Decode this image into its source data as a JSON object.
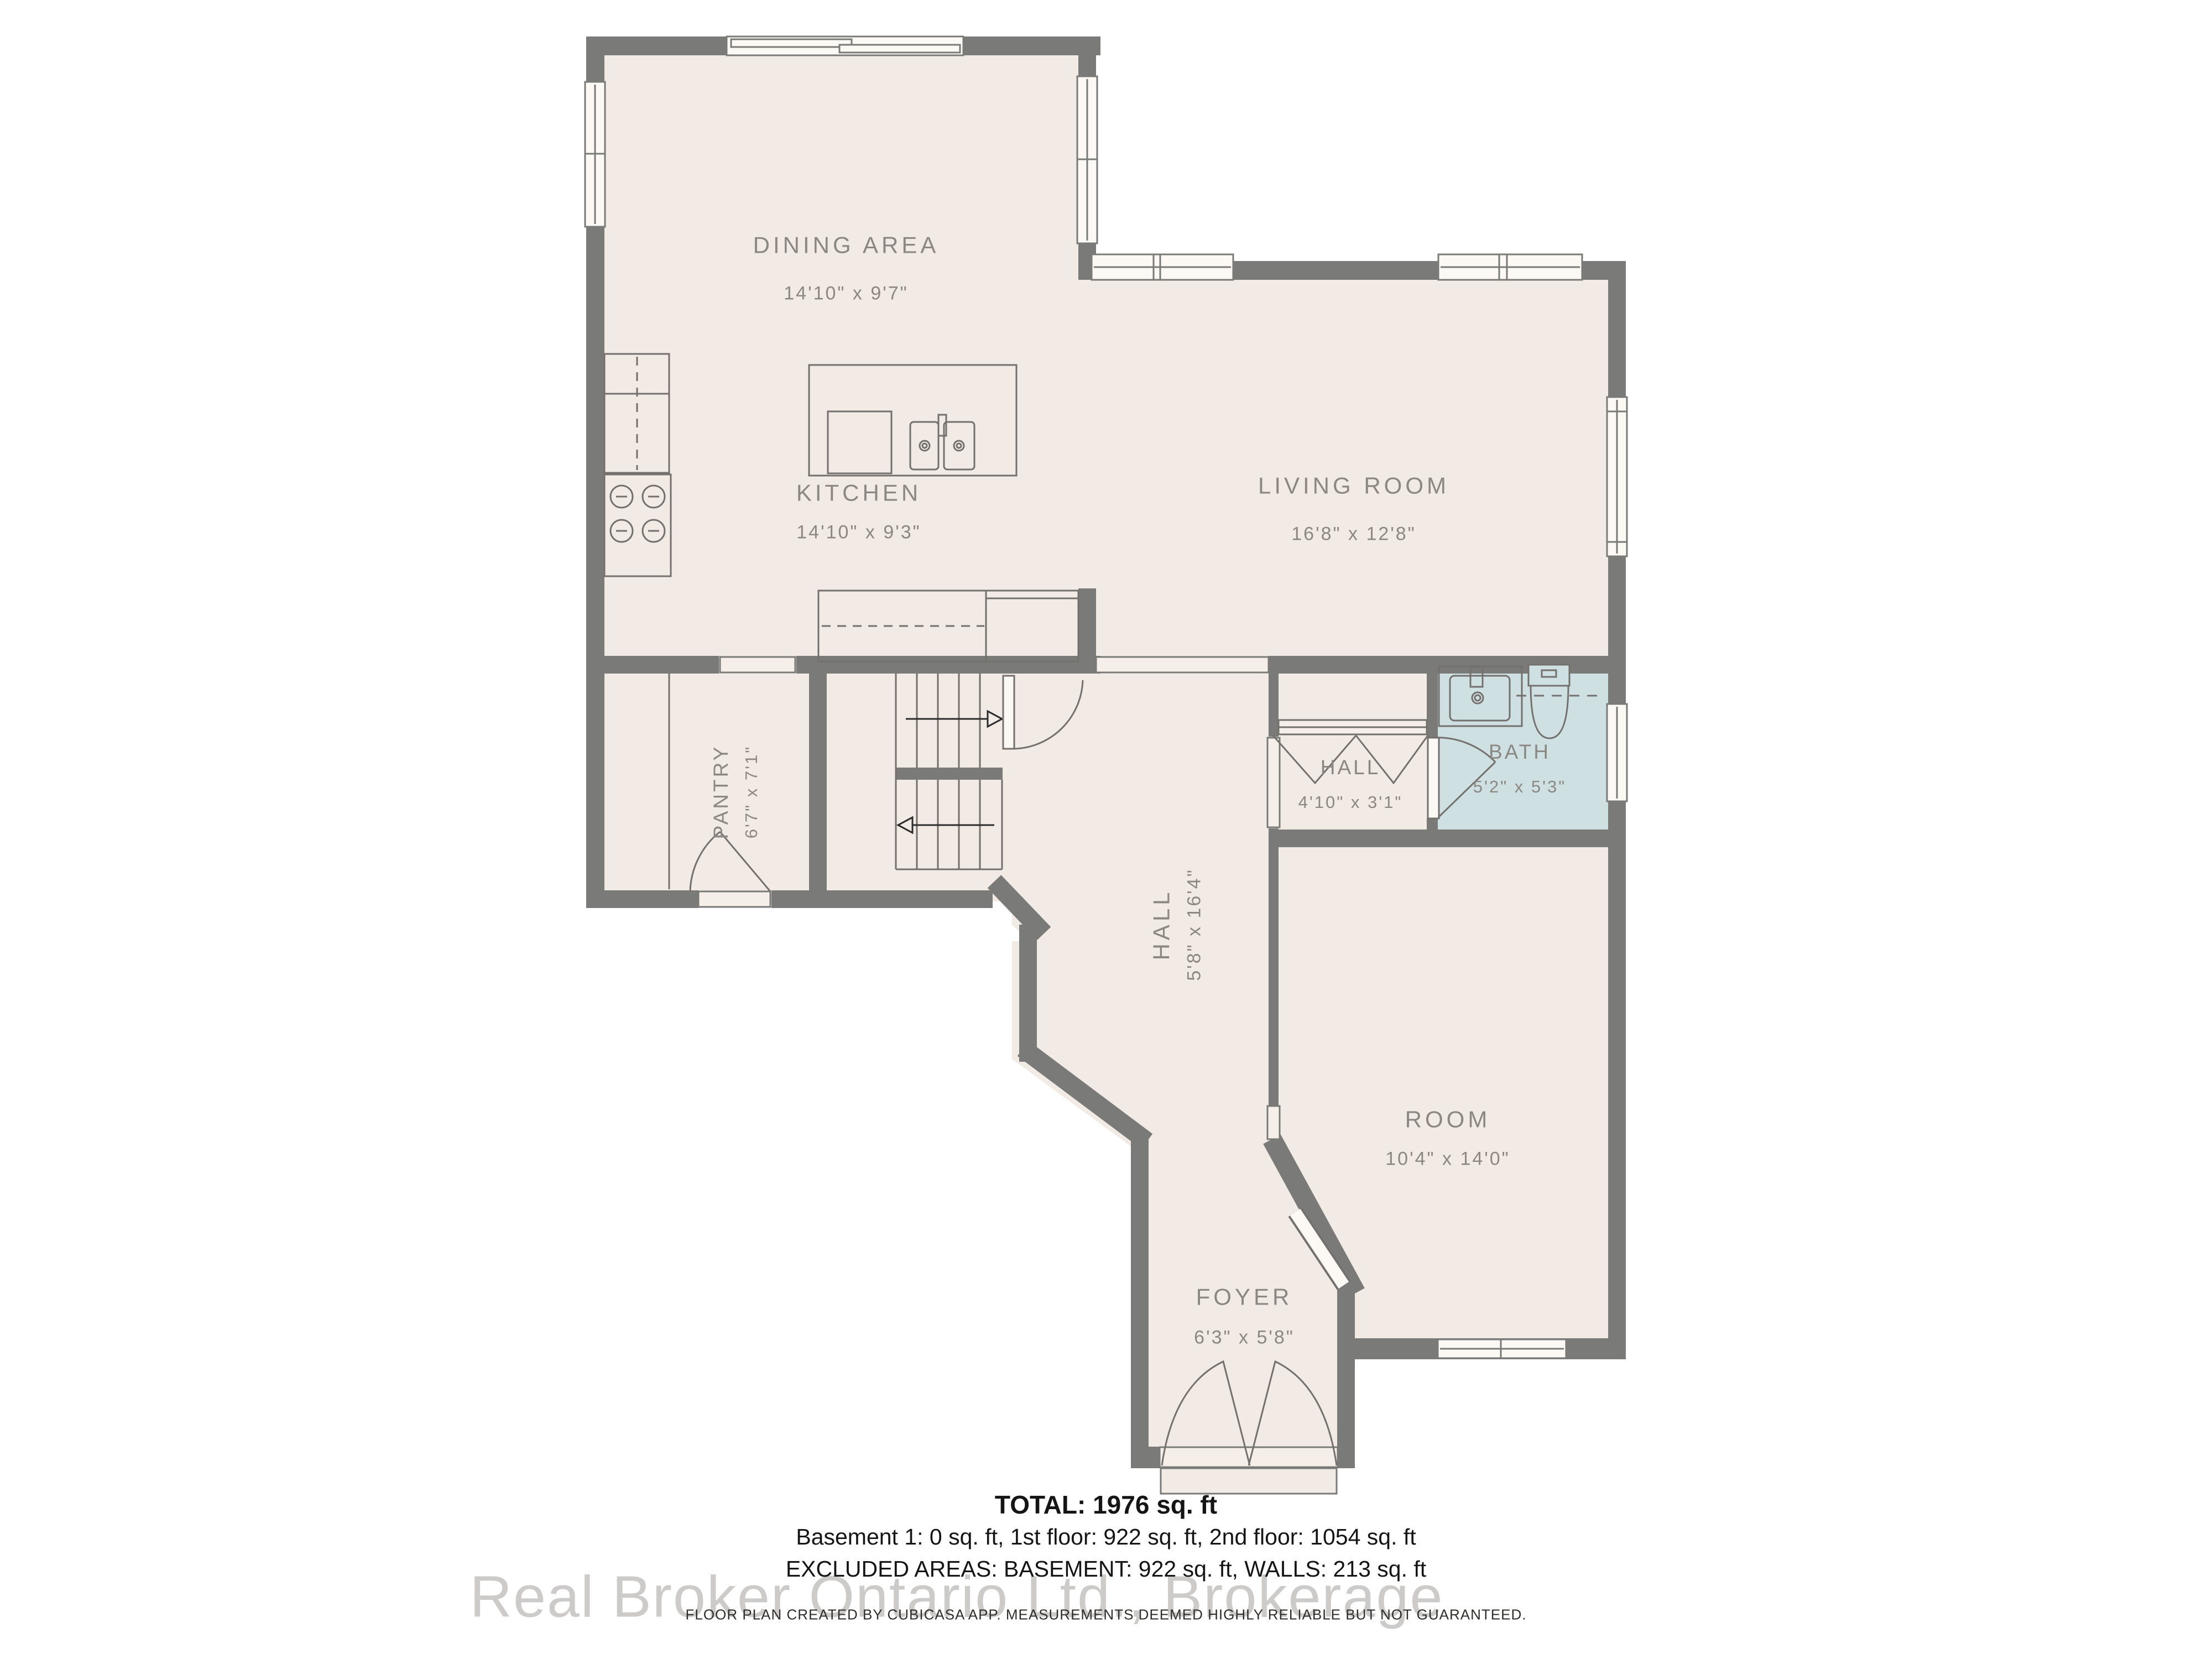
{
  "rooms": {
    "dining": {
      "name": "DINING AREA",
      "dims": "14'10\" x 9'7\""
    },
    "kitchen": {
      "name": "KITCHEN",
      "dims": "14'10\" x 9'3\""
    },
    "living": {
      "name": "LIVING ROOM",
      "dims": "16'8\" x 12'8\""
    },
    "pantry": {
      "name": "PANTRY",
      "dims": "6'7\" x 7'1\""
    },
    "hall": {
      "name": "HALL",
      "dims": "5'8\" x 16'4\""
    },
    "hall2": {
      "name": "HALL",
      "dims": "4'10\" x 3'1\""
    },
    "bath": {
      "name": "BATH",
      "dims": "5'2\" x 5'3\""
    },
    "room": {
      "name": "ROOM",
      "dims": "10'4\" x 14'0\""
    },
    "foyer": {
      "name": "FOYER",
      "dims": "6'3\" x 5'8\""
    }
  },
  "summary": {
    "total": "TOTAL: 1976 sq. ft",
    "floors": "Basement 1: 0 sq. ft, 1st floor: 922 sq. ft, 2nd floor: 1054 sq. ft",
    "excluded": "EXCLUDED AREAS: BASEMENT: 922 sq. ft, WALLS: 213 sq. ft"
  },
  "watermark": "Real Broker Ontario Ltd., Brokerage",
  "disclaimer": "FLOOR PLAN CREATED BY CUBICASA APP. MEASUREMENTS DEEMED HIGHLY RELIABLE BUT NOT GUARANTEED.",
  "colors": {
    "wall": "#7a7a78",
    "floor": "#f2eae4",
    "bath_floor": "#cfe0e3",
    "label": "#8b8783",
    "window_fill": "#fcf8f4",
    "opening_fill": "#f6efe9",
    "watermark": "#c5c3c1"
  }
}
